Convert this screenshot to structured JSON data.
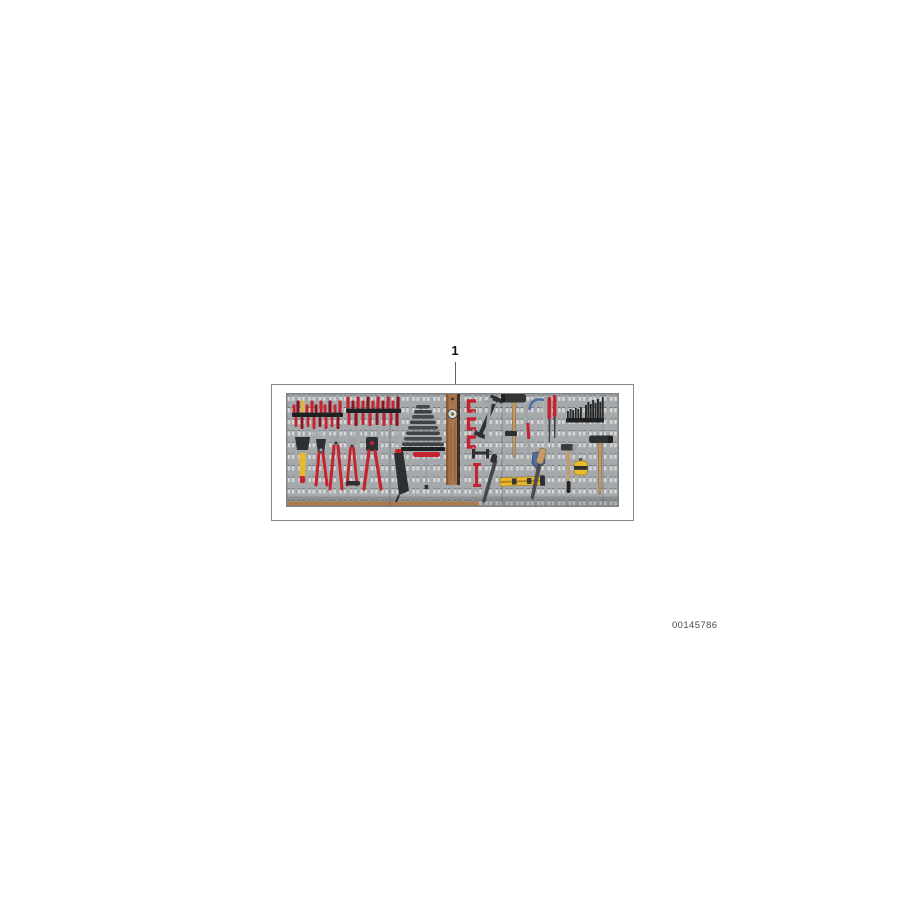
{
  "page": {
    "background": "#ffffff"
  },
  "diagram": {
    "callout": {
      "number": "1"
    },
    "document_number": "00145786",
    "board": {
      "description": "pegboard-tool-wall",
      "colors": {
        "board": "#a6a9ab",
        "slot_light": "#d5d7d8",
        "slot_shadow": "#6c7073",
        "rail_black": "#1f2022",
        "tool_red": "#c32430",
        "tool_red_dark": "#8e1620",
        "tool_yellow": "#e6b92f",
        "wood_light": "#c59a66",
        "tool_dark": "#2e2f31",
        "metal": "#9fa3a6",
        "tool_blue": "#4a6fa5",
        "shelf_brown": "#a97a4e"
      },
      "tools": [
        "screwdriver-rack-left",
        "screwdriver-rack-right",
        "paintbrush",
        "tin-snips",
        "water-pump-pliers",
        "side-cutters",
        "crimping-tool",
        "wrench-pyramid-rack",
        "grease-gun",
        "t-handle-wrench",
        "wooden-spirit-level",
        "mini-red-clamps",
        "f-clamp",
        "try-square",
        "clamp-horizontal",
        "red-bar-clamp",
        "hammer-large",
        "hacksaw",
        "red-handle-files",
        "yellow-level",
        "file-diagonal",
        "chisel",
        "ball-peen-hammer",
        "tape-measure",
        "bit-sets",
        "claw-hammer"
      ]
    }
  }
}
